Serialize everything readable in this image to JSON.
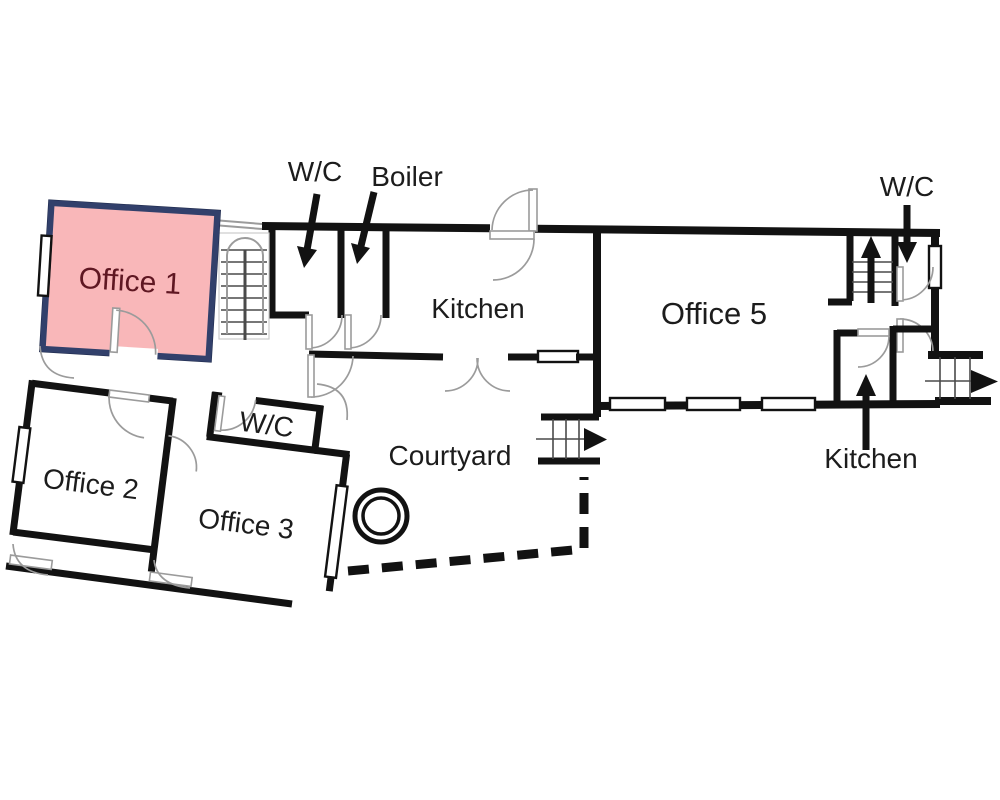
{
  "plan": {
    "labels": {
      "office1": "Office 1",
      "office2": "Office 2",
      "office3": "Office 3",
      "office5": "Office 5",
      "kitchen_main": "Kitchen",
      "kitchen_right": "Kitchen",
      "wc_upper_left": "W/C",
      "wc_upper_right": "W/C",
      "wc_inner": "W/C",
      "boiler": "Boiler",
      "courtyard": "Courtyard"
    },
    "colors": {
      "background": "#ffffff",
      "wall": "#121212",
      "arc_line": "#9b9b9b",
      "stair_line": "#4a4a4a",
      "label_text": "#1c1c1c",
      "highlight_fill": "#f9b7b9",
      "highlight_border": "#32406b",
      "highlight_text": "#5f1722"
    }
  }
}
